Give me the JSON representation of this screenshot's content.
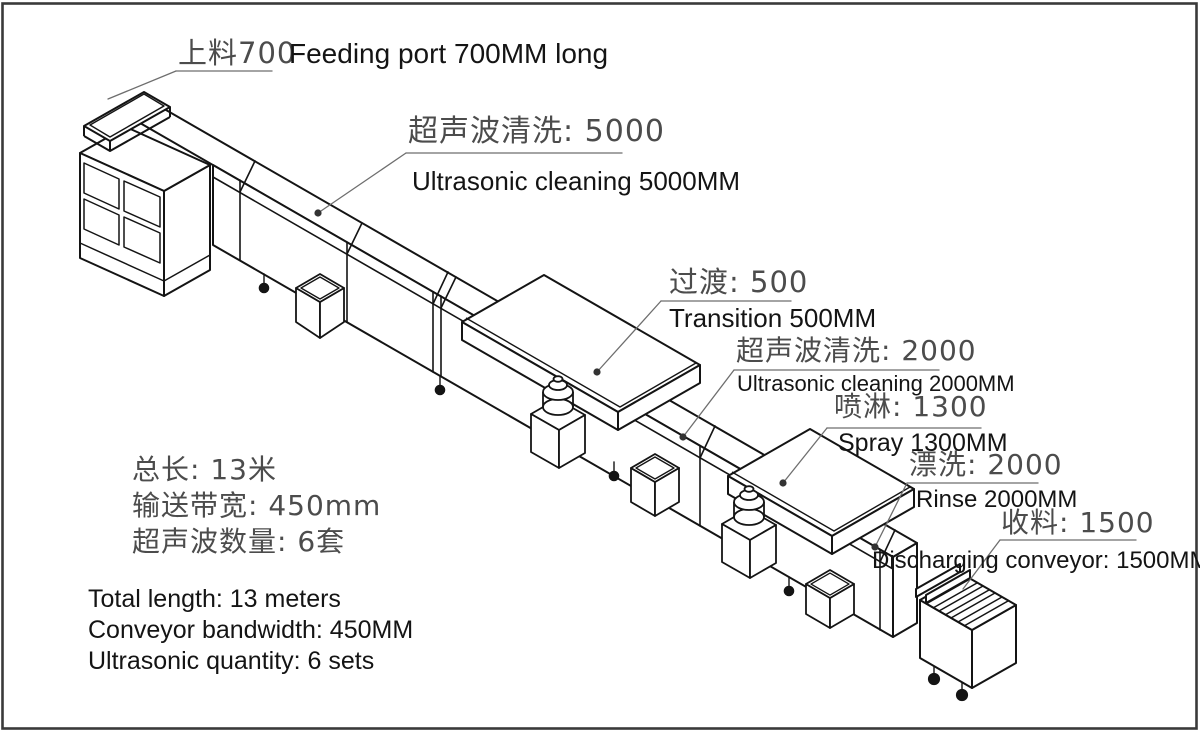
{
  "figure": {
    "type": "isometric-technical-diagram",
    "subject": "ultrasonic cleaning conveyor line",
    "background": "#ffffff",
    "border_color": "#3a3a3a",
    "machine_line_color": "#141414",
    "leader_line_color": "#6e6e6e",
    "cad_text_color": "#4c4c4c",
    "english_text_color": "#141414"
  },
  "callouts": {
    "feeding": {
      "cn": "上料700",
      "en": "Feeding port 700MM long"
    },
    "ultrasonic5000": {
      "cn": "超声波清洗: 5000",
      "en": "Ultrasonic cleaning 5000MM"
    },
    "transition": {
      "cn": "过渡: 500",
      "en": "Transition 500MM"
    },
    "ultrasonic2000": {
      "cn": "超声波清洗: 2000",
      "en": "Ultrasonic cleaning 2000MM"
    },
    "spray": {
      "cn": "喷淋: 1300",
      "en": "Spray 1300MM"
    },
    "rinse": {
      "cn": "漂洗: 2000",
      "en": "Rinse 2000MM"
    },
    "discharge": {
      "cn": "收料: 1500",
      "en": "Discharging conveyor: 1500MM"
    }
  },
  "specs": {
    "cn_lines": [
      "总长: 13米",
      "输送带宽: 450mm",
      "超声波数量: 6套"
    ],
    "en_lines": [
      "Total length: 13 meters",
      "Conveyor bandwidth: 450MM",
      "Ultrasonic quantity: 6 sets"
    ]
  },
  "segments_mm": {
    "feeding": 700,
    "ultrasonic_1": 5000,
    "transition": 500,
    "ultrasonic_2": 2000,
    "spray": 1300,
    "rinse": 2000,
    "discharge": 1500,
    "total_m": 13,
    "belt_width_mm": 450,
    "ultrasonic_sets": 6
  }
}
